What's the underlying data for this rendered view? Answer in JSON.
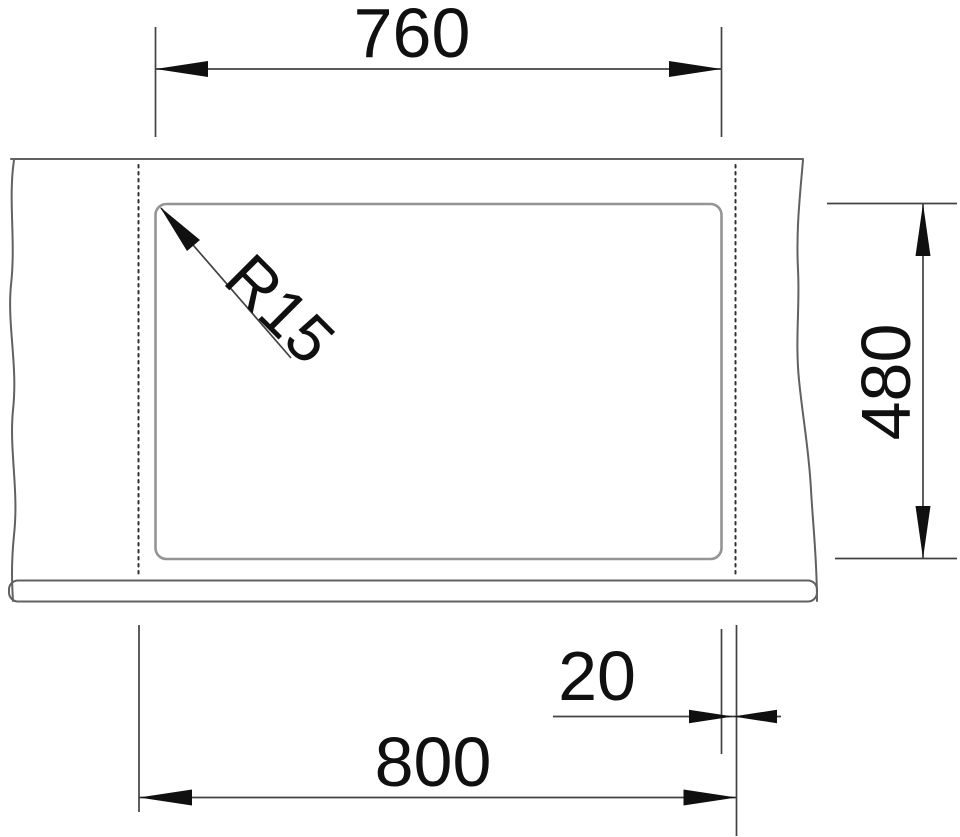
{
  "drawing": {
    "labels": {
      "cutout_width": "760",
      "cutout_depth": "480",
      "corner_radius": "R15",
      "rim_offset": "20",
      "overall_width": "800"
    },
    "colors": {
      "background": "#ffffff",
      "object_line": "#616161",
      "cutout_line": "#949494",
      "hidden_line": "#303030",
      "dimension_line": "#424242",
      "ink": "#101010"
    }
  }
}
